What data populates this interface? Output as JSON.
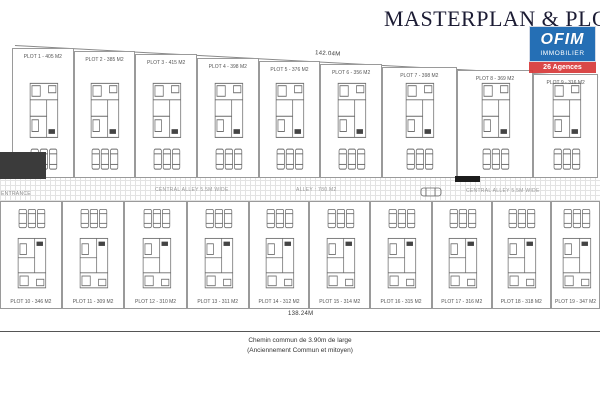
{
  "title": "MASTERPLAN & PLOT AL",
  "logo": {
    "brand": "OFIM",
    "subtitle": "IMMOBILIER",
    "tagline": "26 Agences",
    "blue": "#1565b0",
    "red": "#d83b3b"
  },
  "dimensions": {
    "top_length": "142.04M",
    "bottom_length": "138.24M"
  },
  "alley": {
    "left_label": "CENTRAL ALLEY 5.5M WIDE",
    "area_label": "ALLEY : 780 M2",
    "right_label": "CENTRAL ALLEY 5.5M WIDE",
    "entrance_label": "ENTRANCE"
  },
  "top_row": [
    {
      "label": "PLOT 1 - 405 M2"
    },
    {
      "label": "PLOT 2 - 385 M2"
    },
    {
      "label": "PLOT 3 - 415 M2"
    },
    {
      "label": "PLOT 4 - 398 M2"
    },
    {
      "label": "PLOT 5 - 376 M2"
    },
    {
      "label": "PLOT 6 - 356 M2"
    },
    {
      "label": "PLOT 7 - 398 M2"
    },
    {
      "label": "PLOT 8 - 369 M2"
    },
    {
      "label": "PLOT 9 - 316 M2"
    }
  ],
  "bottom_row": [
    {
      "label": "PLOT 10 - 346 M2"
    },
    {
      "label": "PLOT 11 - 309 M2"
    },
    {
      "label": "PLOT 12 - 310 M2"
    },
    {
      "label": "PLOT 13 - 311 M2"
    },
    {
      "label": "PLOT 14 - 312 M2"
    },
    {
      "label": "PLOT 15 - 314 M2"
    },
    {
      "label": "PLOT 16 - 315 M2"
    },
    {
      "label": "PLOT 17 - 316 M2"
    },
    {
      "label": "PLOT 18 - 318 M2"
    },
    {
      "label": "PLOT 19 - 347 M2"
    }
  ],
  "footer": {
    "line1": "Chemin commun de 3.90m de large",
    "line2": "(Anciennement Commun et mitoyen)"
  }
}
